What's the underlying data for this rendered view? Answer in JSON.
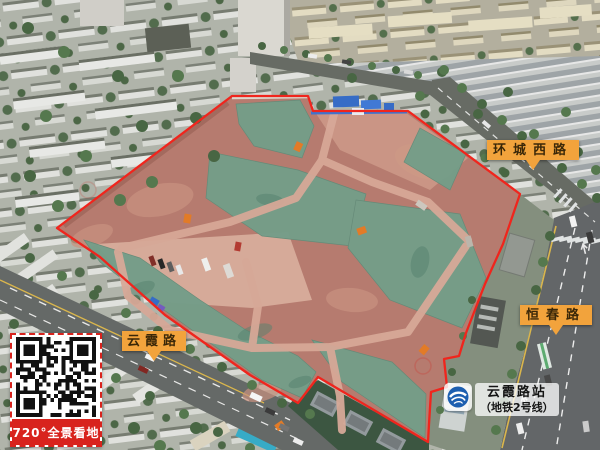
{
  "road_labels": [
    {
      "id": "huancheng-west-road",
      "text": "环城西路"
    },
    {
      "id": "hengchun-road",
      "text": "恒春路"
    },
    {
      "id": "yunxia-road",
      "text": "云霞路"
    }
  ],
  "station_label": {
    "name": "云霞路站",
    "line": "（地铁2号线）"
  },
  "qr_panel": {
    "caption": "720°全景看地"
  },
  "colors": {
    "label_background": "#f2a33c",
    "label_text": "#3a2708",
    "site_boundary_red": "#f01d14",
    "qr_banner_red": "#d8231d",
    "metro_logo_blue": "#1d5fb0",
    "dust_netting_green": "#6f9a85",
    "exposed_earth": "#b3766a"
  }
}
